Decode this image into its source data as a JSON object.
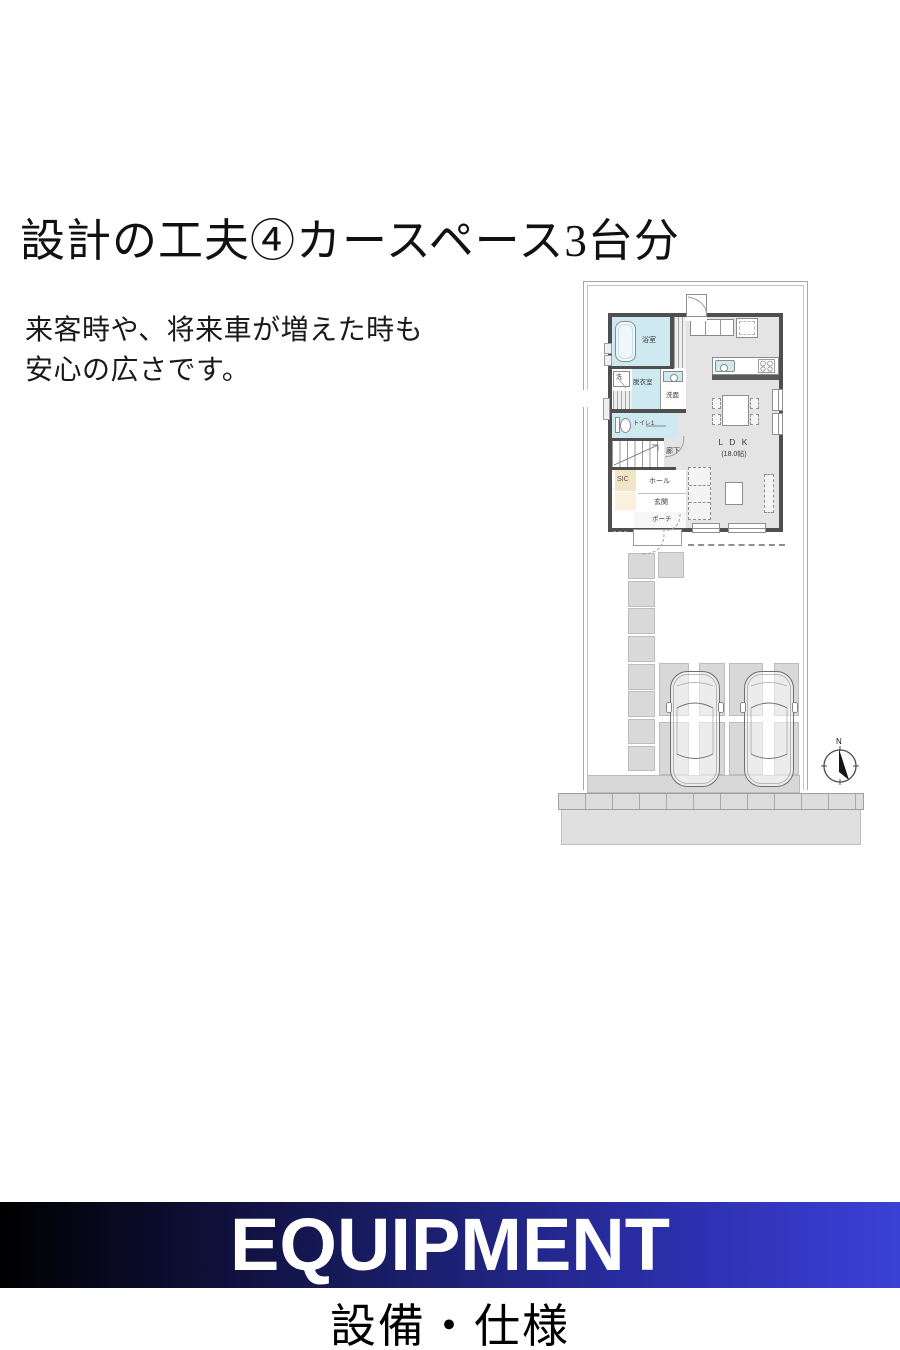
{
  "header": {
    "title": "設計の工夫④カースペース3台分",
    "description_line1": "来客時や、将来車が増えた時も",
    "description_line2": "安心の広さです。"
  },
  "floorplan": {
    "rooms": {
      "bath": "浴室",
      "washer": "洗",
      "dressing_room": "脱衣室",
      "washroom": "洗面",
      "toilet": "トイレ1",
      "corridor": "廊下",
      "shoe_closet": "SIC",
      "hall": "ホール",
      "entrance": "玄関",
      "porch": "ポーチ"
    },
    "ldk": {
      "label": "L D K",
      "size": "(18.0帖)"
    },
    "compass_north": "N",
    "car_count": "3",
    "colors": {
      "wall_dark": "#4f4f4f",
      "room_blue": "#cfe9f0",
      "room_beige": "#f3e4c6",
      "floor_gray": "#e4e4e4",
      "paving_gray": "#d8d8d8"
    }
  },
  "banner": {
    "title": "EQUIPMENT",
    "subtitle": "設備・仕様",
    "gradient_start": "#000000",
    "gradient_end": "#3b40d6"
  }
}
